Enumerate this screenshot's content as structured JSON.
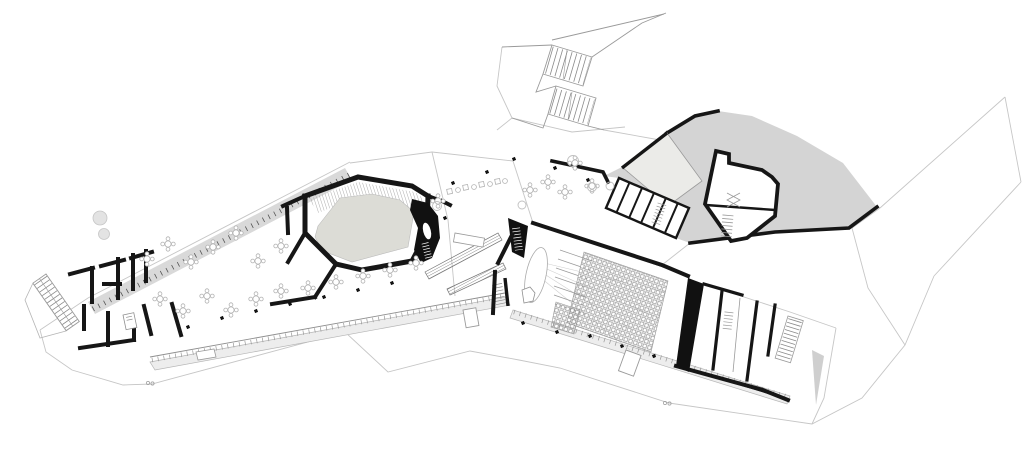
{
  "colors": {
    "paper": "#ffffff",
    "ink": "#161616",
    "poche": "#111111",
    "thin": "#9a9a9a",
    "faint": "#c6c6c6",
    "hill": "#d4d4d4",
    "terrace_band": "#d9d9d9",
    "walkway_band": "#ededed",
    "court_floor": "#dcdcd6",
    "wedge_room": "#ebebe8",
    "gray_triangle": "#cfcfcf",
    "furniture": "#b2b2b2",
    "tread": "#8a8a8a",
    "tree_fill": "#e3e3e3"
  }
}
